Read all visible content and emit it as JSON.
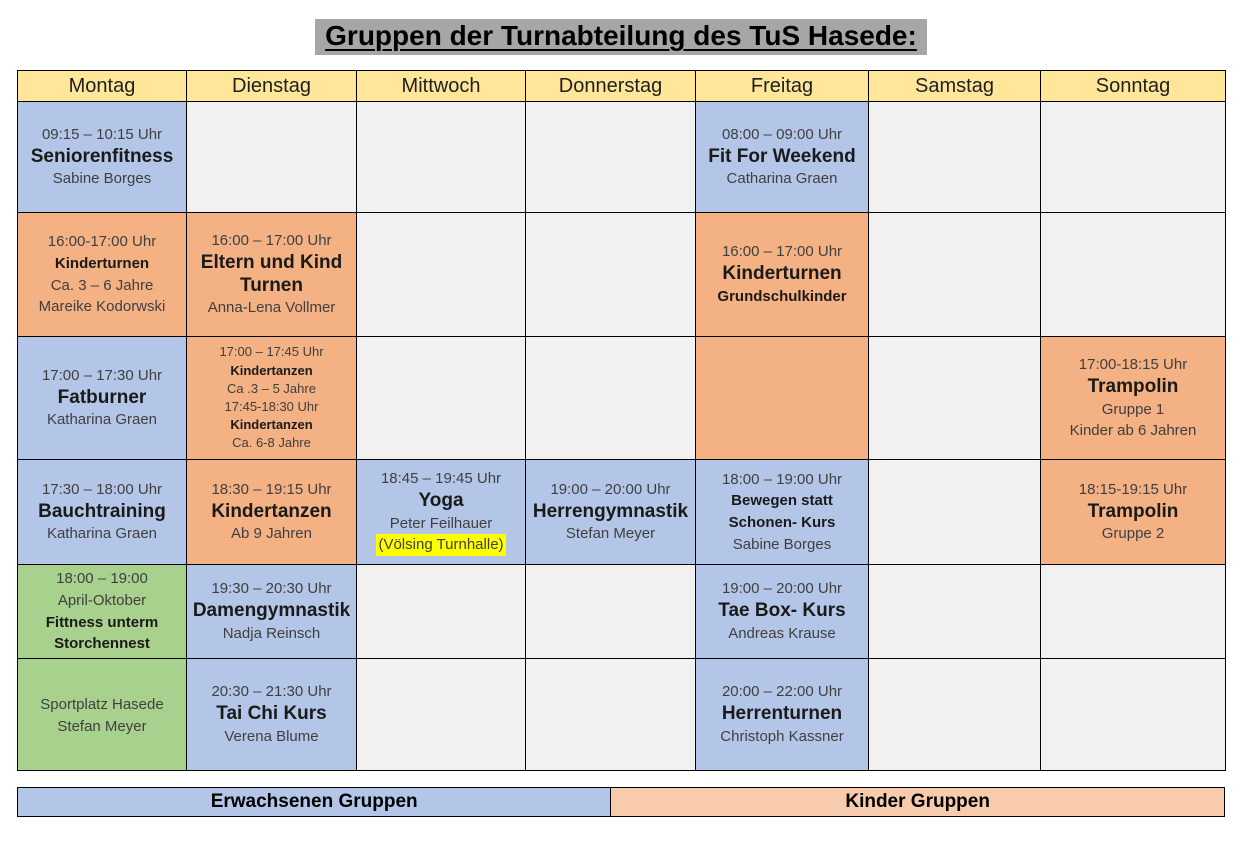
{
  "title": "Gruppen der Turnabteilung des TuS Hasede:",
  "days": [
    "Montag",
    "Dienstag",
    "Mittwoch",
    "Donnerstag",
    "Freitag",
    "Samstag",
    "Sonntag"
  ],
  "colors": {
    "header_yellow": "#FFE699",
    "adult_blue": "#B4C6E7",
    "kids_orange": "#F4B183",
    "outdoor_green": "#A9D18E",
    "empty_gray": "#F1F1F1",
    "legend_kids_peach": "#F8CBAD",
    "title_gray": "#A6A6A6",
    "highlight_yellow": "#FFFF00"
  },
  "rows": [
    {
      "cells": [
        {
          "color": "adult",
          "lines": [
            {
              "t": "09:15 – 10:15 Uhr",
              "s": "time"
            },
            {
              "t": "Seniorenfitness",
              "s": "name"
            },
            {
              "t": "Sabine Borges",
              "s": "sub"
            }
          ]
        },
        {
          "color": "empty"
        },
        {
          "color": "empty"
        },
        {
          "color": "empty"
        },
        {
          "color": "adult",
          "lines": [
            {
              "t": "08:00 – 09:00 Uhr",
              "s": "time"
            },
            {
              "t": "Fit For Weekend",
              "s": "name"
            },
            {
              "t": "Catharina Graen",
              "s": "sub"
            }
          ]
        },
        {
          "color": "empty"
        },
        {
          "color": "empty"
        }
      ]
    },
    {
      "cells": [
        {
          "color": "kids",
          "lines": [
            {
              "t": "16:00-17:00 Uhr",
              "s": "time"
            },
            {
              "t": "Kinderturnen",
              "s": "nameSm"
            },
            {
              "t": "Ca. 3 – 6 Jahre",
              "s": "sub"
            },
            {
              "t": "Mareike Kodorwski",
              "s": "sub"
            }
          ]
        },
        {
          "color": "kids",
          "lines": [
            {
              "t": "16:00 – 17:00 Uhr",
              "s": "time"
            },
            {
              "t": "Eltern und Kind Turnen",
              "s": "name"
            },
            {
              "t": "Anna-Lena Vollmer",
              "s": "sub"
            }
          ]
        },
        {
          "color": "empty"
        },
        {
          "color": "empty"
        },
        {
          "color": "kids",
          "lines": [
            {
              "t": "16:00 – 17:00 Uhr",
              "s": "time"
            },
            {
              "t": "Kinderturnen",
              "s": "name"
            },
            {
              "t": "Grundschulkinder",
              "s": "nameSm"
            }
          ]
        },
        {
          "color": "empty"
        },
        {
          "color": "empty"
        }
      ]
    },
    {
      "cells": [
        {
          "color": "adult",
          "lines": [
            {
              "t": "17:00 – 17:30 Uhr",
              "s": "time"
            },
            {
              "t": "Fatburner",
              "s": "name"
            },
            {
              "t": "Katharina Graen",
              "s": "sub"
            }
          ]
        },
        {
          "color": "kids",
          "lines": [
            {
              "t": "17:00 – 17:45 Uhr",
              "s": "timeSm"
            },
            {
              "t": "Kindertanzen",
              "s": "nameXs"
            },
            {
              "t": "Ca .3 – 5 Jahre",
              "s": "subSm"
            },
            {
              "t": "17:45-18:30 Uhr",
              "s": "timeSm"
            },
            {
              "t": "Kindertanzen",
              "s": "nameXs"
            },
            {
              "t": "Ca. 6-8 Jahre",
              "s": "subSm"
            }
          ]
        },
        {
          "color": "empty"
        },
        {
          "color": "empty"
        },
        {
          "color": "kids"
        },
        {
          "color": "empty"
        },
        {
          "color": "kids",
          "lines": [
            {
              "t": "17:00-18:15 Uhr",
              "s": "time"
            },
            {
              "t": "Trampolin",
              "s": "name"
            },
            {
              "t": "Gruppe 1",
              "s": "sub"
            },
            {
              "t": "Kinder ab 6 Jahren",
              "s": "sub"
            }
          ]
        }
      ]
    },
    {
      "cells": [
        {
          "color": "adult",
          "lines": [
            {
              "t": "17:30 – 18:00 Uhr",
              "s": "time"
            },
            {
              "t": "Bauchtraining",
              "s": "name"
            },
            {
              "t": "Katharina Graen",
              "s": "sub"
            }
          ]
        },
        {
          "color": "kids",
          "lines": [
            {
              "t": "18:30 – 19:15 Uhr",
              "s": "time"
            },
            {
              "t": "Kindertanzen",
              "s": "name"
            },
            {
              "t": "Ab 9 Jahren",
              "s": "sub"
            }
          ]
        },
        {
          "color": "adult",
          "lines": [
            {
              "t": "18:45 – 19:45 Uhr",
              "s": "time"
            },
            {
              "t": "Yoga",
              "s": "name"
            },
            {
              "t": "Peter Feilhauer",
              "s": "sub"
            },
            {
              "t": "(Völsing Turnhalle)",
              "s": "hl"
            }
          ]
        },
        {
          "color": "adult",
          "lines": [
            {
              "t": "19:00 – 20:00 Uhr",
              "s": "time"
            },
            {
              "t": "Herrengymnastik",
              "s": "name"
            },
            {
              "t": "Stefan Meyer",
              "s": "sub"
            }
          ]
        },
        {
          "color": "adult",
          "lines": [
            {
              "t": "18:00 – 19:00 Uhr",
              "s": "time"
            },
            {
              "t": "Bewegen statt Schonen- Kurs",
              "s": "nameSm"
            },
            {
              "t": "Sabine Borges",
              "s": "sub"
            }
          ]
        },
        {
          "color": "empty"
        },
        {
          "color": "kids",
          "lines": [
            {
              "t": "18:15-19:15 Uhr",
              "s": "time"
            },
            {
              "t": "Trampolin",
              "s": "name"
            },
            {
              "t": "Gruppe 2",
              "s": "sub"
            }
          ]
        }
      ]
    },
    {
      "cells": [
        {
          "color": "outdoor",
          "lines": [
            {
              "t": "18:00 – 19:00",
              "s": "time"
            },
            {
              "t": "April-Oktober",
              "s": "sub"
            },
            {
              "t": "Fittness unterm Storchennest",
              "s": "nameSm"
            }
          ]
        },
        {
          "color": "adult",
          "lines": [
            {
              "t": "19:30 – 20:30 Uhr",
              "s": "time"
            },
            {
              "t": "Damengymnastik",
              "s": "name"
            },
            {
              "t": "Nadja Reinsch",
              "s": "sub"
            }
          ]
        },
        {
          "color": "empty"
        },
        {
          "color": "empty"
        },
        {
          "color": "adult",
          "lines": [
            {
              "t": "19:00 – 20:00 Uhr",
              "s": "time"
            },
            {
              "t": "Tae Box- Kurs",
              "s": "name"
            },
            {
              "t": "Andreas Krause",
              "s": "sub"
            }
          ]
        },
        {
          "color": "empty"
        },
        {
          "color": "empty"
        }
      ]
    },
    {
      "cells": [
        {
          "color": "outdoor",
          "valign": "top",
          "lines": [
            {
              "t": "Sportplatz Hasede",
              "s": "sub"
            },
            {
              "t": "Stefan Meyer",
              "s": "sub"
            }
          ]
        },
        {
          "color": "adult",
          "lines": [
            {
              "t": "20:30 – 21:30 Uhr",
              "s": "time"
            },
            {
              "t": "Tai Chi Kurs",
              "s": "name"
            },
            {
              "t": "Verena Blume",
              "s": "sub"
            }
          ]
        },
        {
          "color": "empty"
        },
        {
          "color": "empty"
        },
        {
          "color": "adult",
          "lines": [
            {
              "t": "20:00 – 22:00 Uhr",
              "s": "time"
            },
            {
              "t": "Herrenturnen",
              "s": "name"
            },
            {
              "t": "Christoph Kassner",
              "s": "sub"
            }
          ]
        },
        {
          "color": "empty"
        },
        {
          "color": "empty"
        }
      ]
    }
  ],
  "legend": [
    {
      "label": "Erwachsenen Gruppen",
      "color_key": "adult_blue"
    },
    {
      "label": "Kinder Gruppen",
      "color_key": "legend_kids_peach"
    }
  ]
}
